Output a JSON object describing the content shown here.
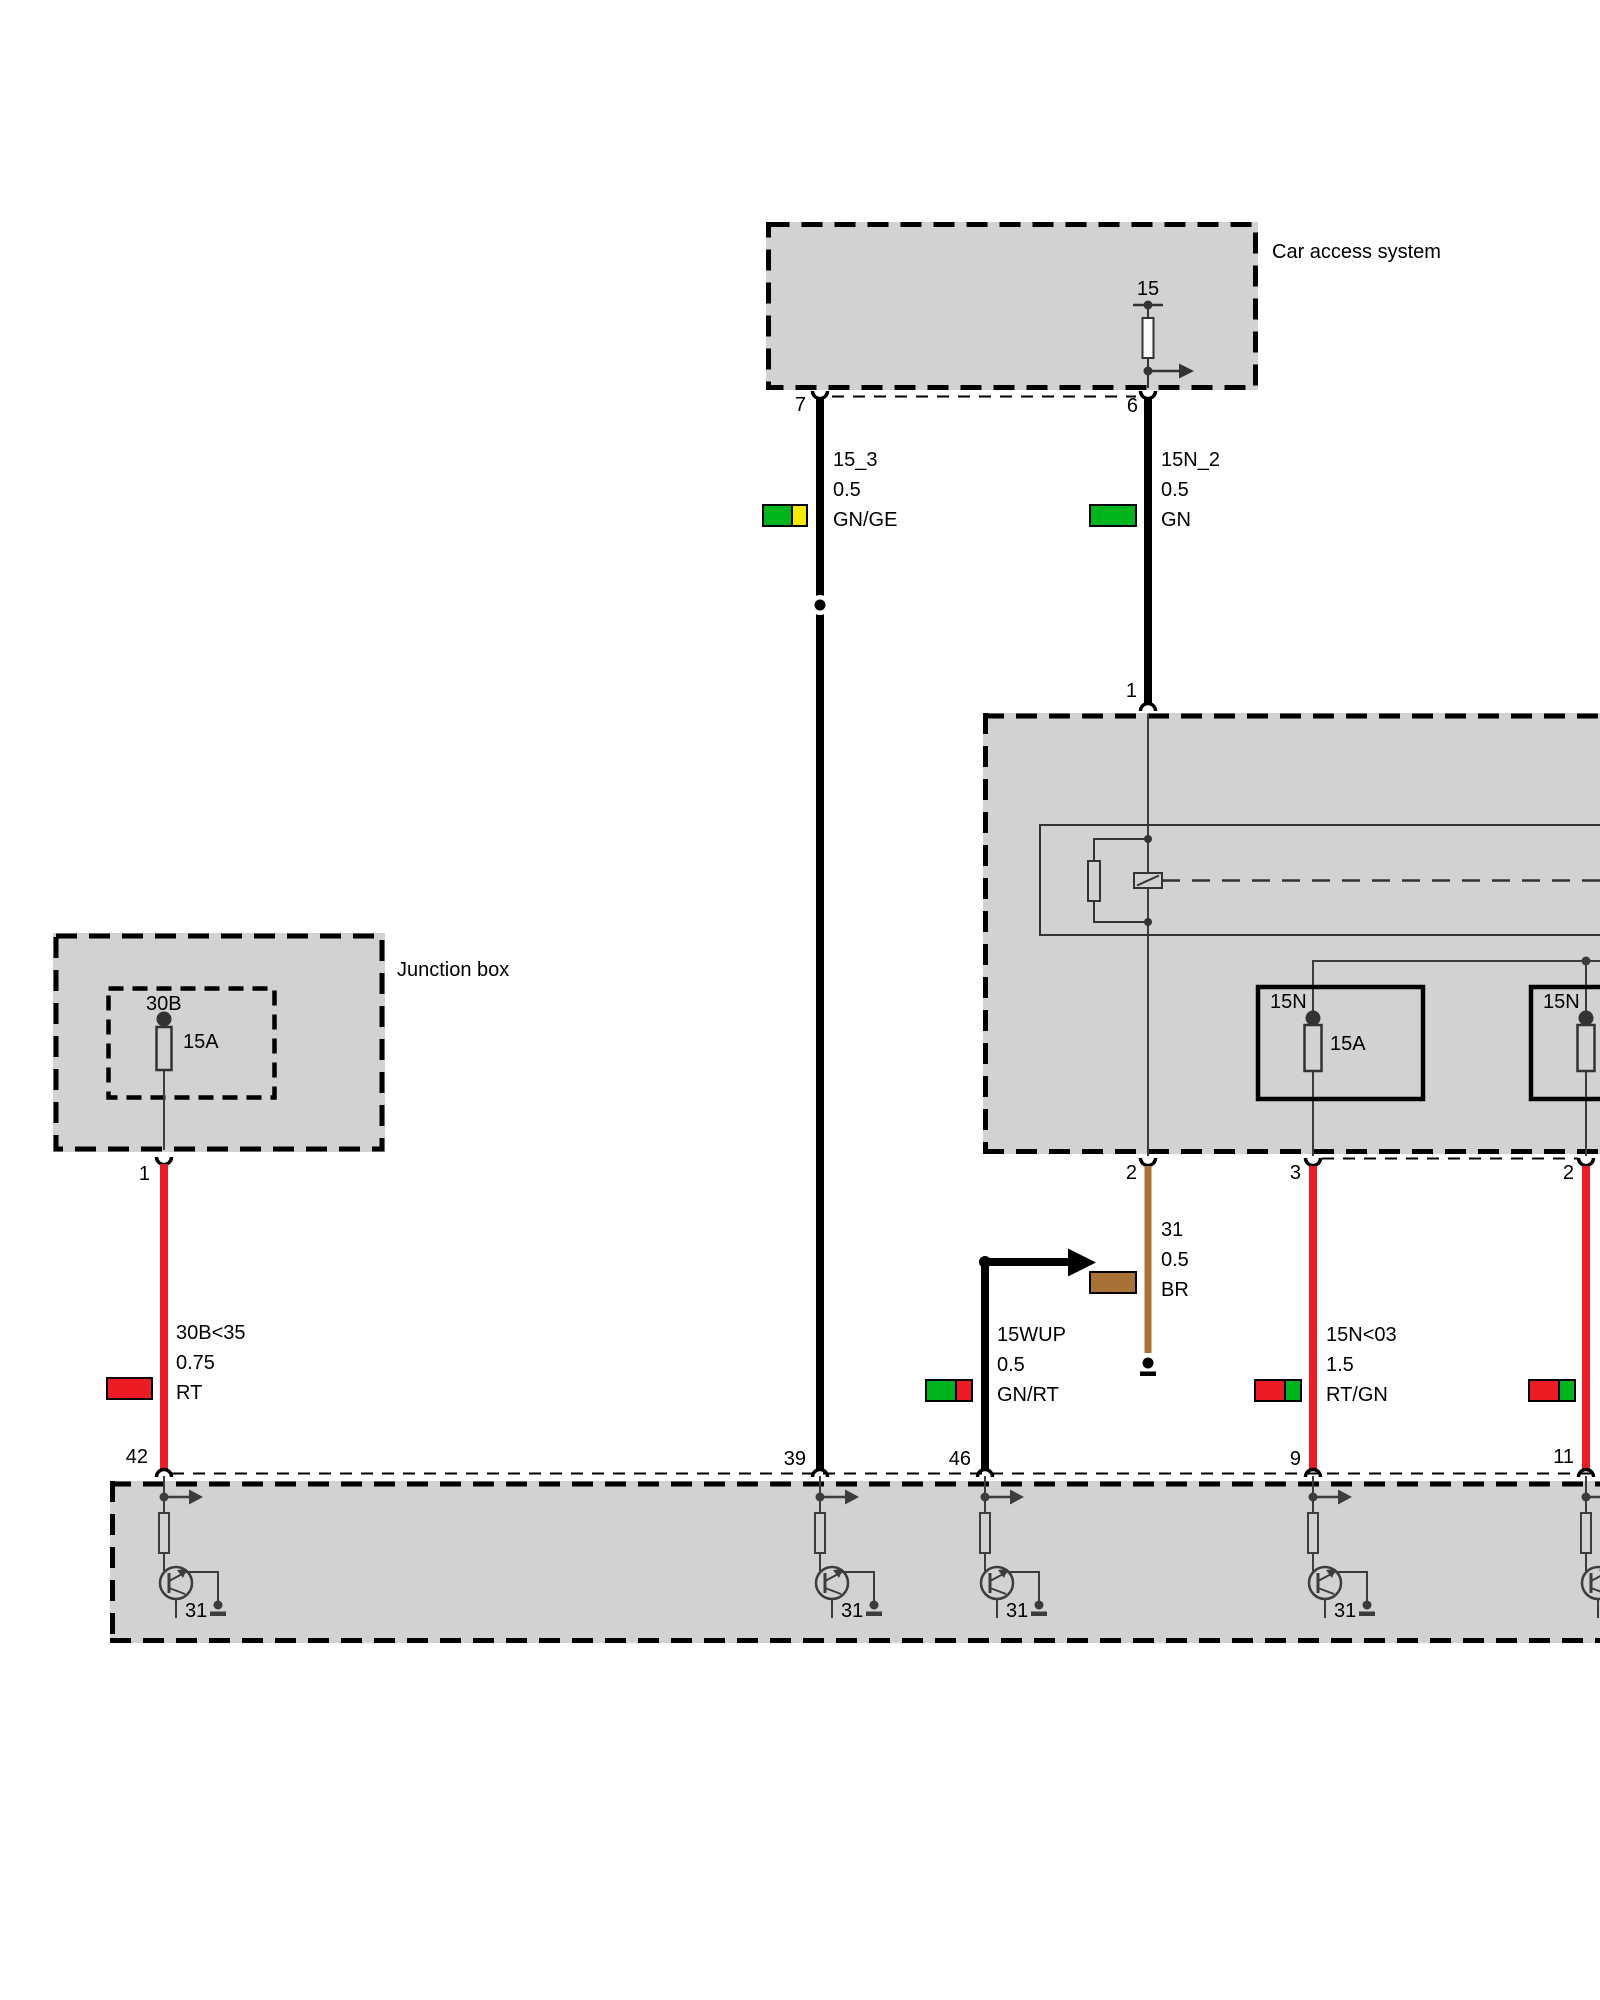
{
  "boxes": {
    "car_access": {
      "title": "Car access system",
      "terminal": "15",
      "pin_7": "7",
      "pin_6": "6"
    },
    "relay_fuse_box": {
      "pin_1": "1",
      "pin_2_left": "2",
      "pin_3": "3",
      "pin_2_right": "2",
      "fuse_left_name": "15N",
      "fuse_left_rating": "15A",
      "fuse_right_name": "15N"
    },
    "junction_box": {
      "title": "Junction box",
      "fuse_name": "30B",
      "fuse_rating": "15A",
      "pin_1": "1"
    },
    "bottom_box": {
      "pin_42": "42",
      "pin_39": "39",
      "pin_46": "46",
      "pin_9": "9",
      "pin_11": "11",
      "ground_label": "31"
    }
  },
  "wires": {
    "w15_3": {
      "name": "15_3",
      "gauge": "0.5",
      "color_code": "GN/GE"
    },
    "w15n_2": {
      "name": "15N_2",
      "gauge": "0.5",
      "color_code": "GN"
    },
    "w31": {
      "name": "31",
      "gauge": "0.5",
      "color_code": "BR"
    },
    "w15wup": {
      "name": "15WUP",
      "gauge": "0.5",
      "color_code": "GN/RT"
    },
    "w30b35": {
      "name": "30B<35",
      "gauge": "0.75",
      "color_code": "RT"
    },
    "w15n03": {
      "name": "15N<03",
      "gauge": "1.5",
      "color_code": "RT/GN"
    }
  },
  "colors": {
    "green": "#00B41E",
    "yellow": "#F2EA00",
    "red": "#ED1C24",
    "brown": "#A87236",
    "box_fill": "#D2D2D2"
  }
}
